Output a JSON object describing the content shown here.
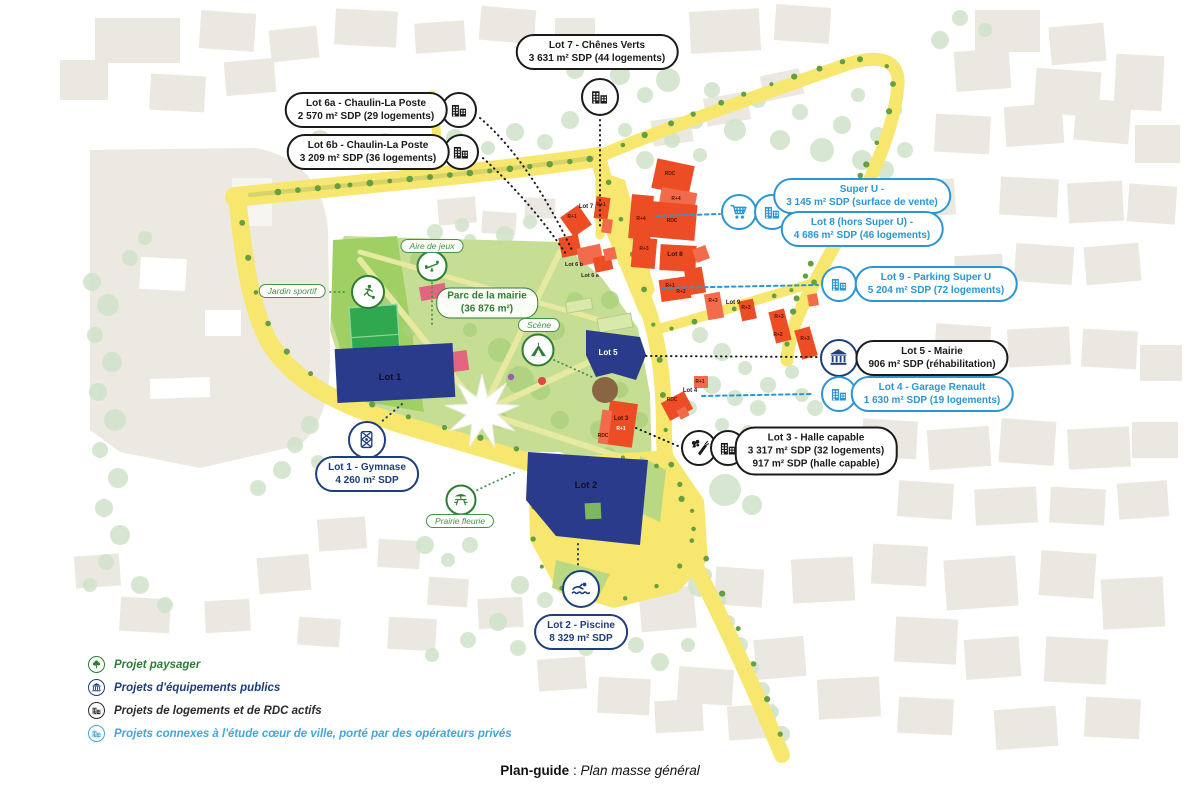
{
  "caption": {
    "term": "Plan-guide",
    "separator": " : ",
    "text": "Plan masse général"
  },
  "legend": {
    "items": [
      {
        "label": "Projet paysager",
        "icon": "tree-icon",
        "color": "#2e7d32"
      },
      {
        "label": "Projets d'équipements publics",
        "icon": "bank-icon",
        "color": "#1d3d7b"
      },
      {
        "label": "Projets de logements et de RDC actifs",
        "icon": "building-icon",
        "color": "#2b2b2b"
      },
      {
        "label": "Projets connexes à l'étude cœur de ville, porté par des opérateurs privés",
        "icon": "building-icon",
        "color": "#45a5da"
      }
    ]
  },
  "callouts": {
    "lot7": {
      "lines": [
        "Lot 7 - Chênes Verts",
        "3 631 m² SDP (44 logements)"
      ]
    },
    "lot6a": {
      "lines": [
        "Lot 6a - Chaulin-La Poste",
        "2 570 m² SDP (29 logements)"
      ]
    },
    "lot6b": {
      "lines": [
        "Lot 6b - Chaulin-La Poste",
        "3 209 m² SDP (36 logements)"
      ]
    },
    "superu": {
      "lines": [
        "Super U -",
        "3 145 m² SDP (surface de vente)"
      ]
    },
    "lot8": {
      "lines": [
        "Lot 8 (hors Super U) -",
        "4 686 m² SDP (46 logements)"
      ]
    },
    "lot9": {
      "lines": [
        "Lot 9 - Parking Super U",
        "5 204 m² SDP (72 logements)"
      ]
    },
    "lot5": {
      "lines": [
        "Lot 5 - Mairie",
        "906 m² SDP (réhabilitation)"
      ]
    },
    "lot4": {
      "lines": [
        "Lot 4 - Garage Renault",
        "1 630 m² SDP (19 logements)"
      ]
    },
    "lot3": {
      "lines": [
        "Lot 3 - Halle capable",
        "3 317 m² SDP (32 logements)",
        "917 m² SDP (halle capable)"
      ]
    },
    "lot1": {
      "lines": [
        "Lot 1 - Gymnase",
        "4 260 m² SDP"
      ]
    },
    "lot2": {
      "lines": [
        "Lot 2 - Piscine",
        "8 329 m² SDP"
      ]
    }
  },
  "park_labels": {
    "aire": "Aire de jeux",
    "jardin": "Jardin sportif",
    "parc": {
      "lines": [
        "Parc de la mairie",
        "(36 876 m²)"
      ]
    },
    "scene": "Scène",
    "prairie": "Prairie fleurie"
  },
  "map_labels": [
    {
      "text": "Lot 7",
      "x": 586,
      "y": 208,
      "size": 6,
      "color": "#222"
    },
    {
      "text": "Lot 6 b",
      "x": 574,
      "y": 266,
      "size": 5.5,
      "color": "#222"
    },
    {
      "text": "Lot 6 a",
      "x": 590,
      "y": 277,
      "size": 5.5,
      "color": "#222"
    },
    {
      "text": "Lot 8",
      "x": 675,
      "y": 256,
      "size": 6.5,
      "color": "#3a1000"
    },
    {
      "text": "Lot 9",
      "x": 733,
      "y": 304,
      "size": 6,
      "color": "#222"
    },
    {
      "text": "Lot 5",
      "x": 608,
      "y": 355,
      "size": 8,
      "color": "#fff"
    },
    {
      "text": "Lot 1",
      "x": 390,
      "y": 380,
      "size": 9.5,
      "color": "#111"
    },
    {
      "text": "Lot 2",
      "x": 586,
      "y": 488,
      "size": 9.5,
      "color": "#111"
    },
    {
      "text": "Lot 3",
      "x": 621,
      "y": 420,
      "size": 6,
      "color": "#3a1000"
    },
    {
      "text": "Lot 4",
      "x": 690,
      "y": 392,
      "size": 6,
      "color": "#222"
    },
    {
      "text": "RDC",
      "x": 670,
      "y": 175,
      "size": 5,
      "color": "#5c1400"
    },
    {
      "text": "R+1",
      "x": 601,
      "y": 206,
      "size": 5,
      "color": "#5c1400"
    },
    {
      "text": "R+4",
      "x": 641,
      "y": 220,
      "size": 5,
      "color": "#5c1400"
    },
    {
      "text": "R+4",
      "x": 676,
      "y": 200,
      "size": 5,
      "color": "#5c1400"
    },
    {
      "text": "RDC",
      "x": 672,
      "y": 222,
      "size": 5,
      "color": "#5c1400"
    },
    {
      "text": "R+3",
      "x": 644,
      "y": 250,
      "size": 5,
      "color": "#5c1400"
    },
    {
      "text": "R+1",
      "x": 572,
      "y": 218,
      "size": 5,
      "color": "#5c1400"
    },
    {
      "text": "R+1",
      "x": 670,
      "y": 287,
      "size": 5,
      "color": "#5c1400"
    },
    {
      "text": "R+2",
      "x": 681,
      "y": 293,
      "size": 5,
      "color": "#5c1400"
    },
    {
      "text": "R+3",
      "x": 713,
      "y": 302,
      "size": 5,
      "color": "#5c1400"
    },
    {
      "text": "R+3",
      "x": 746,
      "y": 309,
      "size": 5,
      "color": "#5c1400"
    },
    {
      "text": "R+3",
      "x": 779,
      "y": 318,
      "size": 5,
      "color": "#5c1400"
    },
    {
      "text": "R+2",
      "x": 778,
      "y": 336,
      "size": 5,
      "color": "#5c1400"
    },
    {
      "text": "R+3",
      "x": 805,
      "y": 340,
      "size": 5,
      "color": "#5c1400"
    },
    {
      "text": "R+1",
      "x": 700,
      "y": 383,
      "size": 5,
      "color": "#5c1400"
    },
    {
      "text": "R+1",
      "x": 621,
      "y": 430,
      "size": 5,
      "color": "#fff"
    },
    {
      "text": "RDC",
      "x": 603,
      "y": 437,
      "size": 5,
      "color": "#5c1400"
    },
    {
      "text": "RDC",
      "x": 672,
      "y": 401,
      "size": 5,
      "color": "#5c1400"
    }
  ],
  "colors": {
    "black_callout": "#1a1a1a",
    "blue_callout": "#2a96d3",
    "navy_callout": "#1d3d7b",
    "green_label": "#2e7d34",
    "light_blue_legend": "#45a5da",
    "road_yellow": "#f7e76e",
    "park_green": "#c6de93",
    "building_red": "#ed4d25",
    "building_navy": "#2b3b8c"
  }
}
